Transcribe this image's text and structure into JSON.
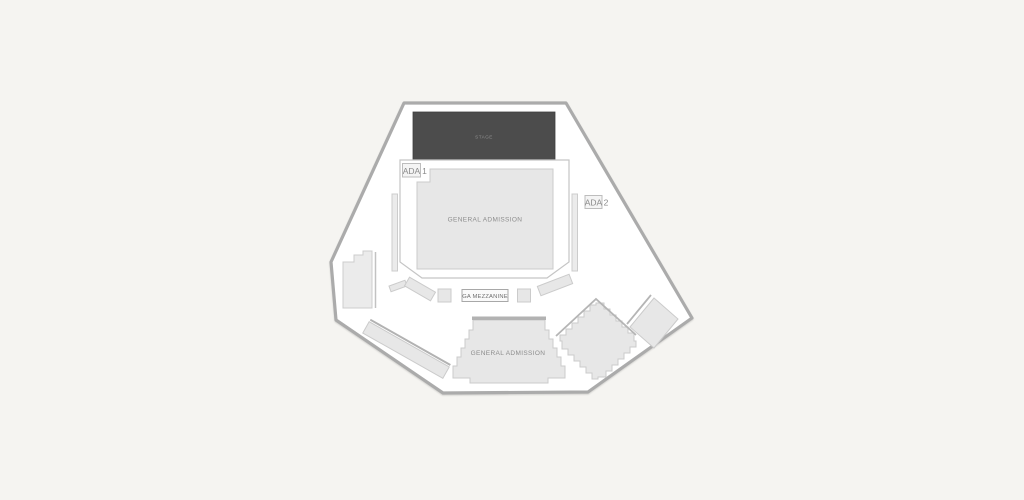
{
  "colors": {
    "background": "#f5f4f1",
    "venue_fill": "#ffffff",
    "venue_outline": "#ababab",
    "section_fill": "#e7e7e7",
    "section_border": "#cbcbcb",
    "stage_fill": "#4c4c4c",
    "stage_text": "#8f8f8f",
    "label_text": "#8a8a8a",
    "rail_line": "#b5b5b5"
  },
  "map": {
    "stage": {
      "label": "STAGE"
    },
    "ga_floor": {
      "label": "GENERAL ADMISSION"
    },
    "ga_lower": {
      "label": "GENERAL ADMISSION"
    },
    "ga_mezzanine": {
      "label": "GA MEZZANINE"
    },
    "ada_1": {
      "box_label": "ADA",
      "number": "1"
    },
    "ada_2": {
      "box_label": "ADA",
      "number": "2"
    }
  }
}
